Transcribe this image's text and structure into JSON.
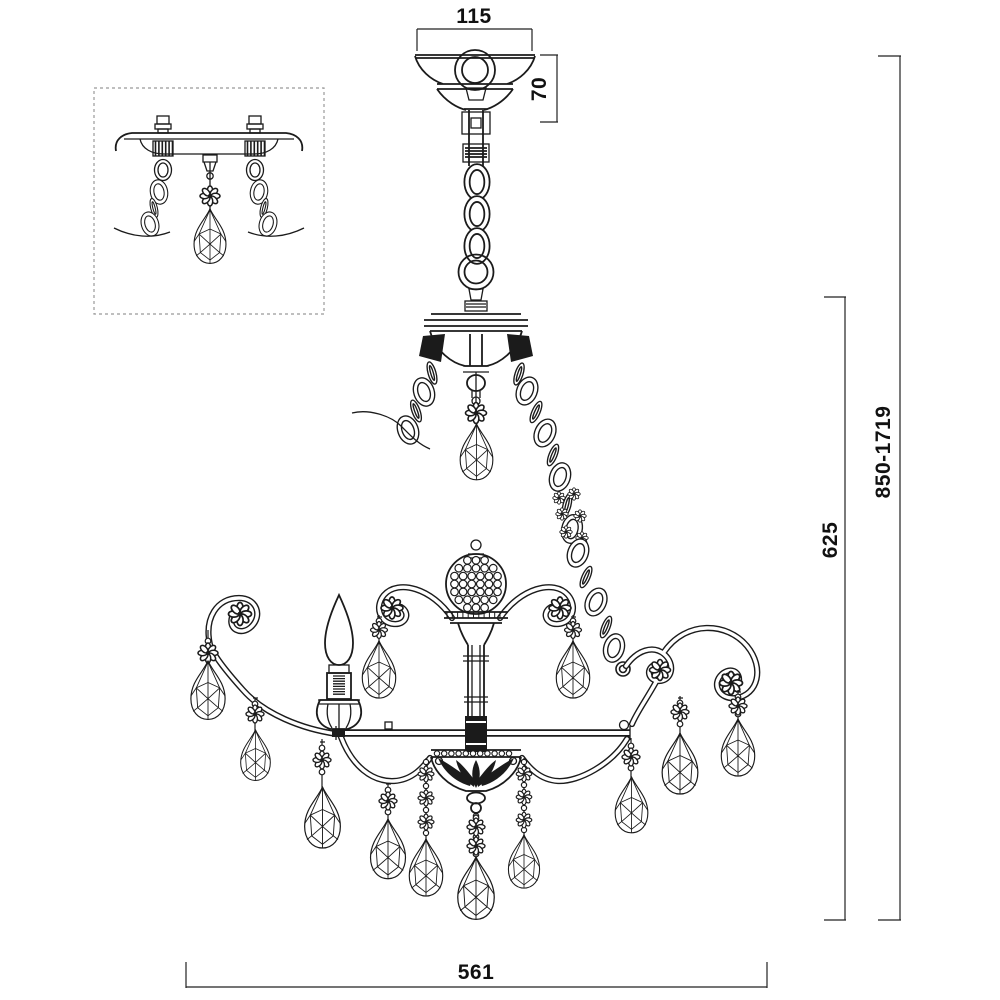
{
  "dimensions": {
    "canopy_width": "115",
    "canopy_height": "70",
    "suspension_height_range": "850-1719",
    "body_height": "625",
    "body_width": "561"
  },
  "colors": {
    "line": "#1b1b1b",
    "background": "#ffffff",
    "inset_border": "#999999"
  }
}
